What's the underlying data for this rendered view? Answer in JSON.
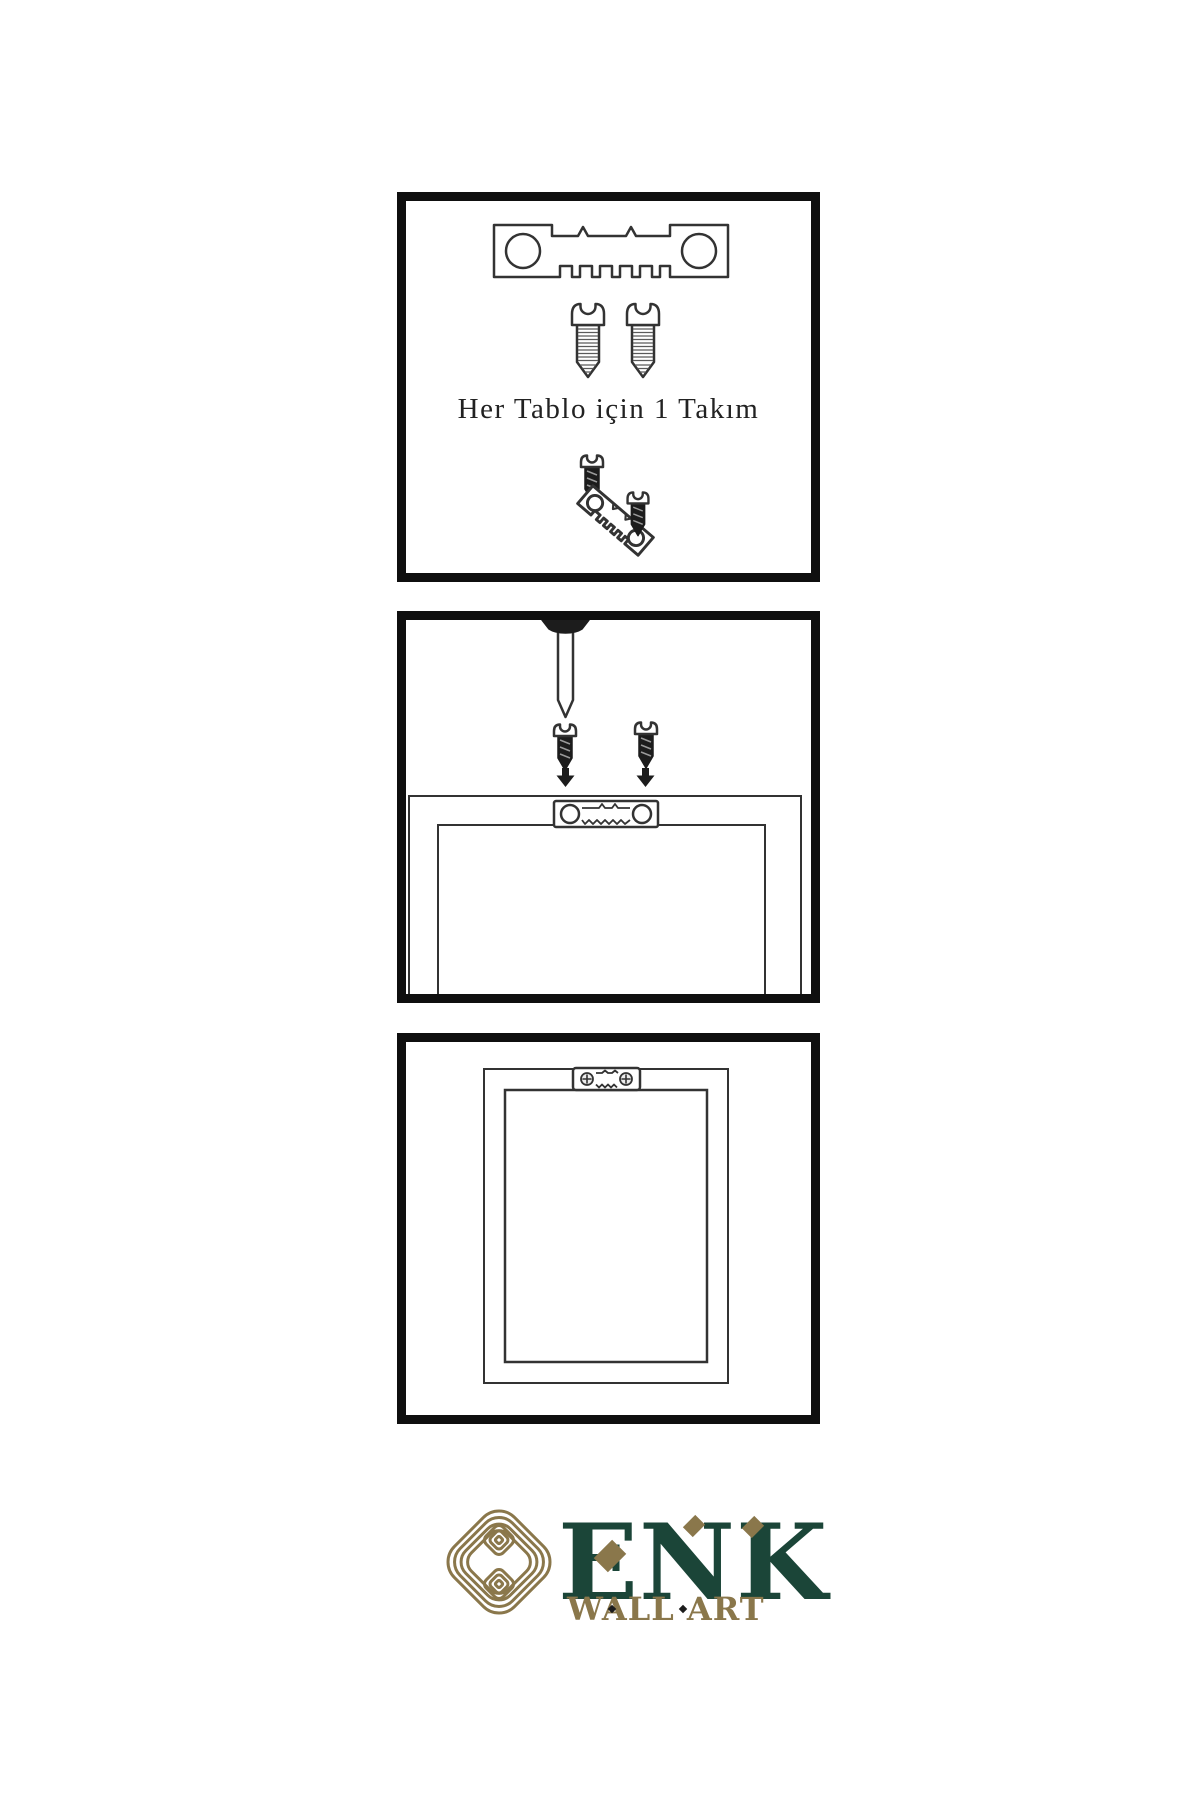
{
  "page": {
    "background": "#ffffff"
  },
  "colors": {
    "line": "#333333",
    "dark": "#1c1c1c",
    "border": "#0f0f0f",
    "gold": "#8a774b",
    "green": "#1b4538",
    "text": "#222222"
  },
  "steps": {
    "step1": {
      "caption": "Her Tablo için 1 Takım",
      "icons": [
        "sawtooth-hanger-icon",
        "screw-icon",
        "screw-icon",
        "dark-screw-icon",
        "angled-sawtooth-hanger-icon",
        "dark-screw-icon"
      ]
    },
    "step2": {
      "caption": "",
      "icons": [
        "wall-nail-icon",
        "dark-screw-icon",
        "dark-screw-icon",
        "down-arrow-icon",
        "down-arrow-icon",
        "frame-back-icon",
        "sawtooth-hanger-icon"
      ]
    },
    "step3": {
      "caption": "",
      "icons": [
        "frame-front-icon",
        "mounted-sawtooth-hanger-icon",
        "phillips-screw-icon",
        "phillips-screw-icon"
      ]
    }
  },
  "brand": {
    "name": "ENK",
    "tagline": "WALL ART",
    "logo_icon": "interlocking-knot-icon",
    "accent_icon": "diamond-icon"
  }
}
